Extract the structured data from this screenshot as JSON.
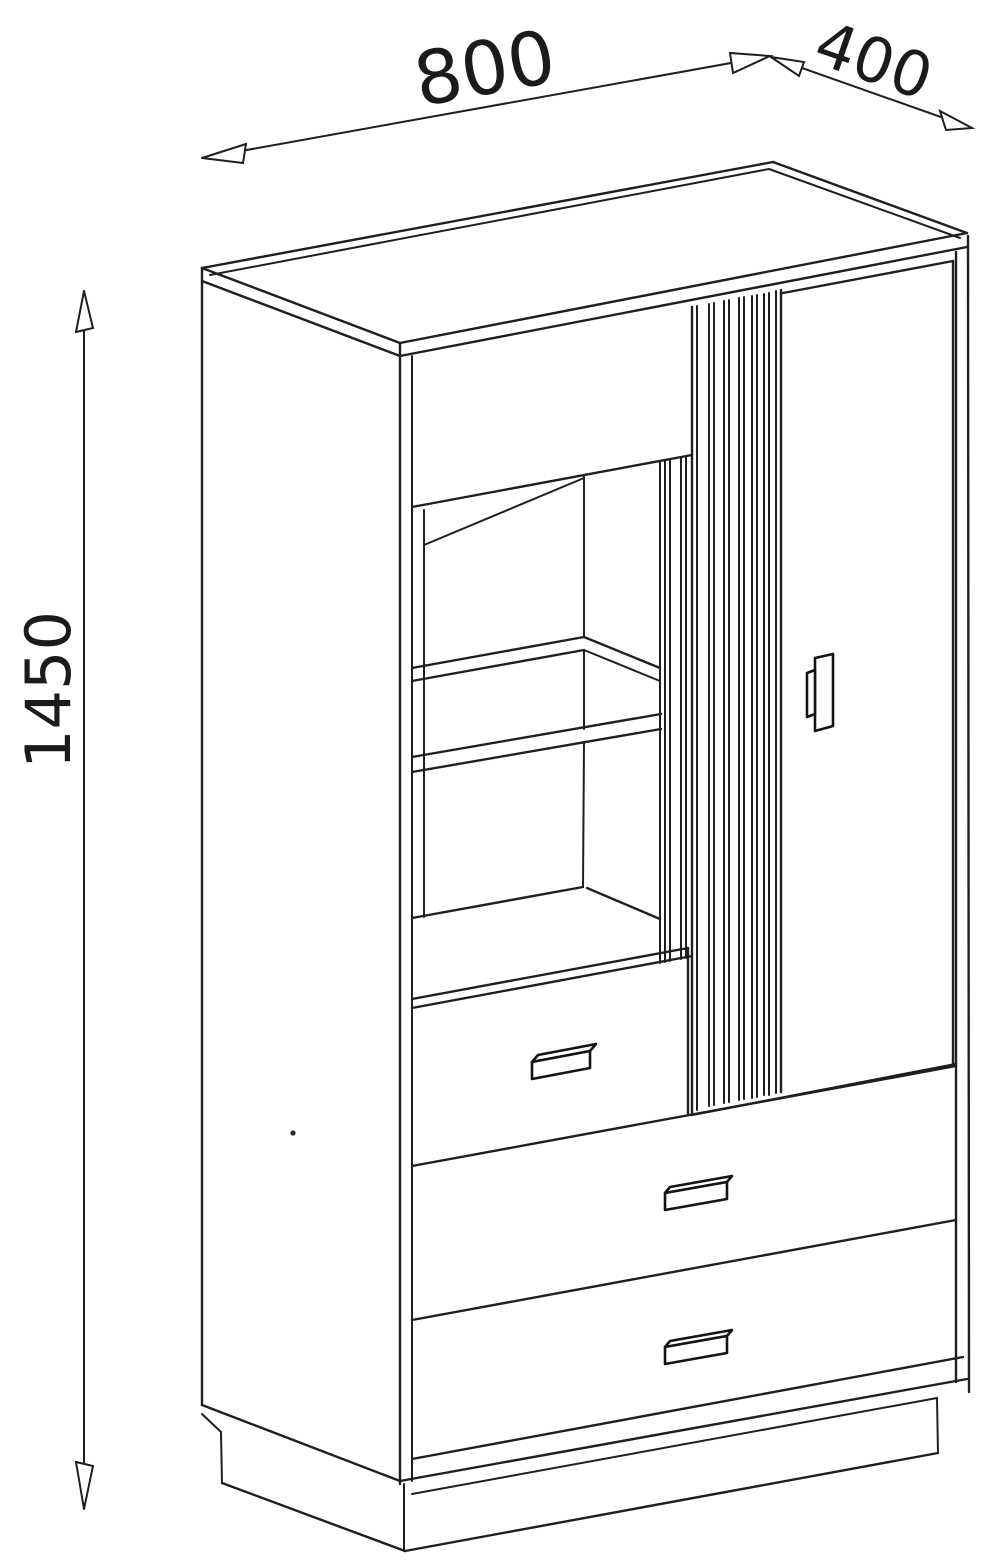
{
  "drawing": {
    "title": "cabinet-technical-drawing",
    "dimensions": {
      "width": {
        "value": "800"
      },
      "depth": {
        "value": "400"
      },
      "height": {
        "value": "1450"
      }
    },
    "colors": {
      "background": "#ffffff",
      "line": "#1f1f1f"
    }
  }
}
